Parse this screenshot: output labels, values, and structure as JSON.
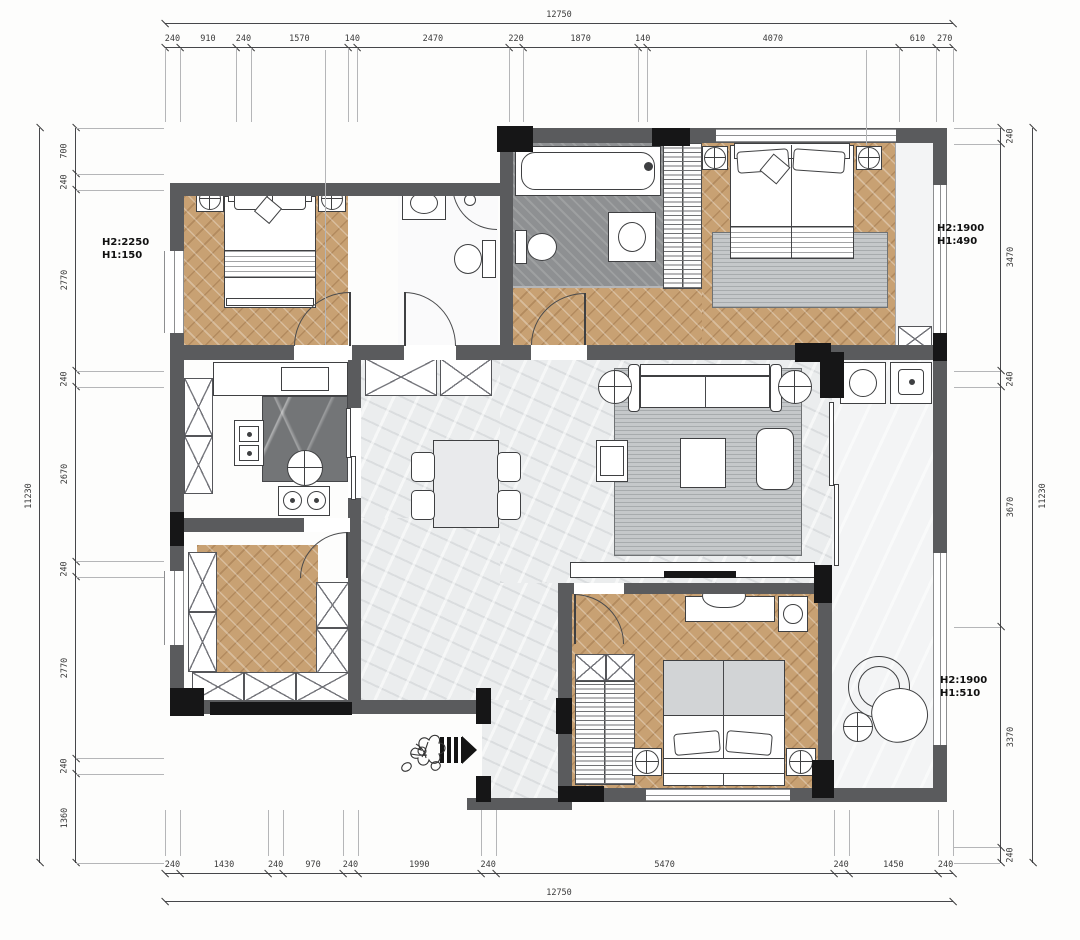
{
  "dimensions": {
    "top": {
      "overall": "12750",
      "segments": [
        240,
        910,
        240,
        1570,
        140,
        2470,
        220,
        1870,
        140,
        4070,
        610,
        270
      ]
    },
    "bottom": {
      "overall": "12750",
      "segments": [
        240,
        1430,
        240,
        970,
        240,
        1990,
        240,
        5470,
        240,
        1450,
        240
      ]
    },
    "left": {
      "overall": "11230",
      "segments": [
        700,
        240,
        2770,
        240,
        2670,
        240,
        2770,
        240,
        1360
      ]
    },
    "right": {
      "overall": "11230",
      "segments": [
        240,
        3470,
        240,
        3670,
        3370,
        240
      ]
    }
  },
  "window_labels": {
    "left": {
      "line1": "H2:2250",
      "line2": "H1:150"
    },
    "right_top": {
      "line1": "H2:1900",
      "line2": "H1:490"
    },
    "right_bottom": {
      "line1": "H2:1900",
      "line2": "H1:510"
    }
  },
  "colors": {
    "wall": "#5a5b5d",
    "pier": "#161617",
    "wood_floor": "#c8a173",
    "tile_floor": "#ebedee",
    "dark_tile": "#8e9092",
    "rug": "#c5c8ca",
    "dim_text": "#3a3a3a"
  }
}
